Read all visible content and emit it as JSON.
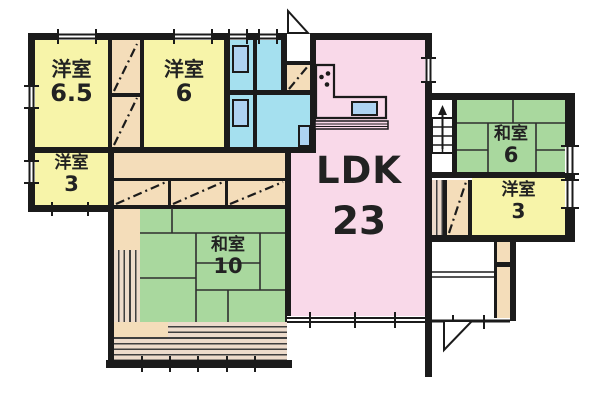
{
  "floor_plan": {
    "rooms": [
      {
        "id": "western-room-6-5",
        "name": "洋室",
        "size": "6.5"
      },
      {
        "id": "western-room-6",
        "name": "洋室",
        "size": "6"
      },
      {
        "id": "western-room-3-left",
        "name": "洋室",
        "size": "3"
      },
      {
        "id": "japanese-room-10",
        "name": "和室",
        "size": "10"
      },
      {
        "id": "ldk",
        "name": "LDK",
        "size": "23"
      },
      {
        "id": "japanese-room-6",
        "name": "和室",
        "size": "6"
      },
      {
        "id": "western-room-3-right",
        "name": "洋室",
        "size": "3"
      }
    ],
    "legend_colors": {
      "western_room": "#f7f4a9",
      "japanese_room": "#a9d89e",
      "ldk": "#f9d9e9",
      "sanitary": "#a5e0ef",
      "closet": "#f4ddba",
      "veranda": "#eddbcb",
      "fixture": "#aed3f2",
      "wall": "#1b1b1b",
      "hall": "#ffffff"
    },
    "features": [
      "stairs-up-arrow",
      "entrance-door-swing",
      "back-door-swing",
      "kitchen-counter-with-sink",
      "stove-burner-dots",
      "toilet-fixtures",
      "washbasin",
      "closet-diagonal-marks",
      "tatami-mat-lines",
      "veranda-decking-stripes",
      "window-marks"
    ]
  }
}
